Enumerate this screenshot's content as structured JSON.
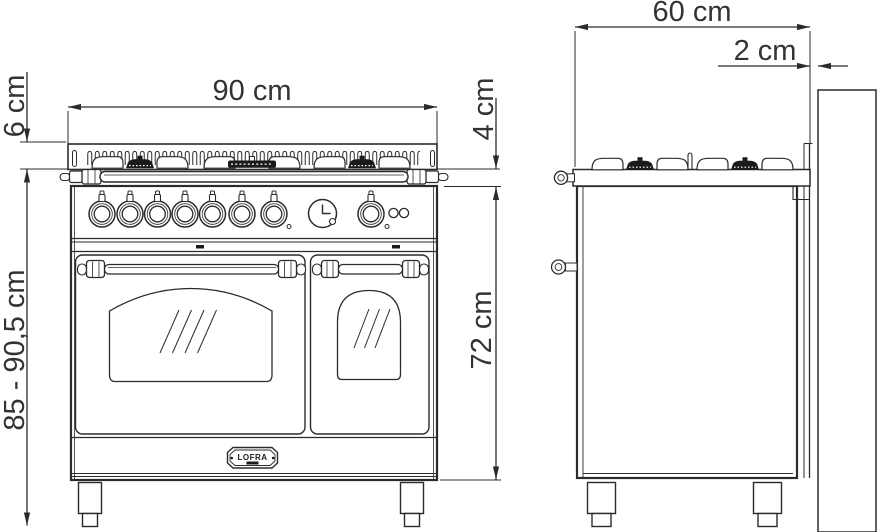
{
  "dimensions": {
    "front_width": "90 cm",
    "hob_edge_height": "6 cm",
    "overall_height_range": "85 - 90,5 cm",
    "worktop_edge_height": "4 cm",
    "body_height": "72 cm",
    "depth": "60 cm",
    "rear_wall_gap": "2 cm"
  },
  "brand": {
    "badge_text": "LOFRA"
  },
  "colors": {
    "line": "#2b2b2b",
    "text": "#333333",
    "burner_fill": "#1a1a1a",
    "background": "#ffffff"
  }
}
